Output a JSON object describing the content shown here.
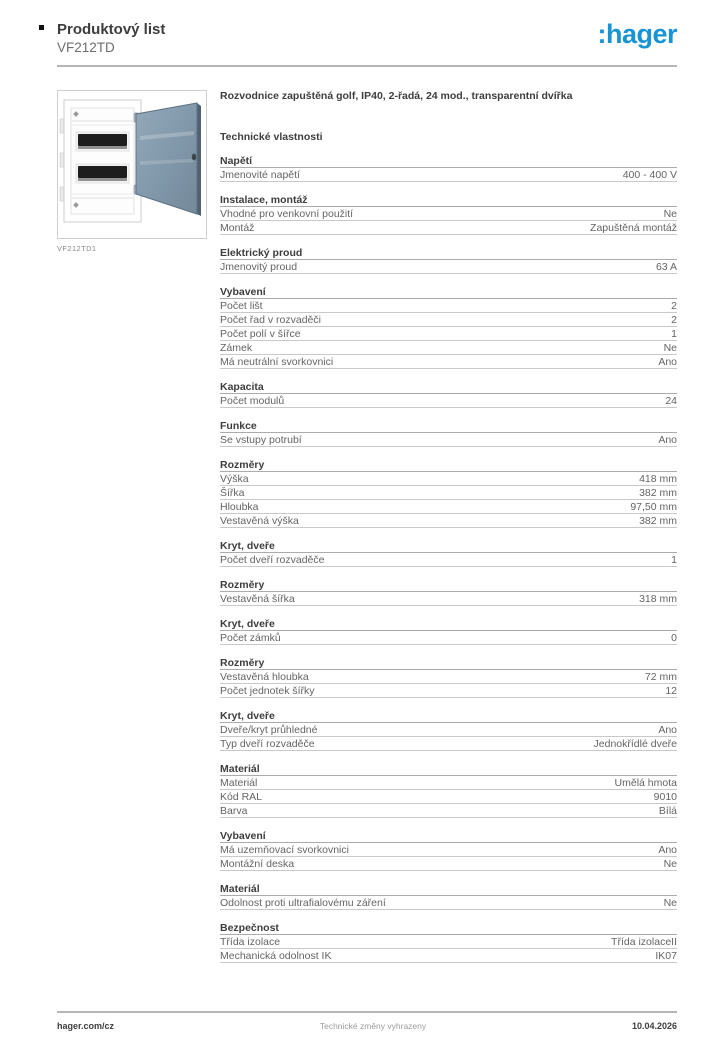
{
  "header": {
    "doc_type": "Produktový list",
    "product_code": "VF212TD",
    "brand_logo": ":hager",
    "brand_color": "#1794d1"
  },
  "figure": {
    "caption": "VF212TD1",
    "image_name": "flush-mounted-distribution-board-with-transparent-door",
    "door_color": "#8499ab",
    "enclosure_color": "#ffffff"
  },
  "description": "Rozvodnice zapuštěná golf, IP40, 2-řadá, 24 mod., transparentní dvířka",
  "tech_heading": "Technické vlastnosti",
  "sections": [
    {
      "title": "Napětí",
      "rows": [
        {
          "label": "Jmenovité napětí",
          "value": "400 - 400 V"
        }
      ]
    },
    {
      "title": "Instalace, montáž",
      "rows": [
        {
          "label": "Vhodné pro venkovní použití",
          "value": "Ne"
        },
        {
          "label": "Montáž",
          "value": "Zapuštěná montáž"
        }
      ]
    },
    {
      "title": "Elektrický proud",
      "rows": [
        {
          "label": "Jmenovitý proud",
          "value": "63 A"
        }
      ]
    },
    {
      "title": "Vybavení",
      "rows": [
        {
          "label": "Počet lišt",
          "value": "2"
        },
        {
          "label": "Počet řad v rozvaděči",
          "value": "2"
        },
        {
          "label": "Počet polí v šířce",
          "value": "1"
        },
        {
          "label": "Zámek",
          "value": "Ne"
        },
        {
          "label": "Má neutrální svorkovnici",
          "value": "Ano"
        }
      ]
    },
    {
      "title": "Kapacita",
      "rows": [
        {
          "label": "Počet modulů",
          "value": "24"
        }
      ]
    },
    {
      "title": "Funkce",
      "rows": [
        {
          "label": "Se vstupy potrubí",
          "value": "Ano"
        }
      ]
    },
    {
      "title": "Rozměry",
      "rows": [
        {
          "label": "Výška",
          "value": "418 mm"
        },
        {
          "label": "Šířka",
          "value": "382 mm"
        },
        {
          "label": "Hloubka",
          "value": "97,50 mm"
        },
        {
          "label": "Vestavěná výška",
          "value": "382 mm"
        }
      ]
    },
    {
      "title": "Kryt, dveře",
      "rows": [
        {
          "label": "Počet dveří rozvaděče",
          "value": "1"
        }
      ]
    },
    {
      "title": "Rozměry",
      "rows": [
        {
          "label": "Vestavěná šířka",
          "value": "318 mm"
        }
      ]
    },
    {
      "title": "Kryt, dveře",
      "rows": [
        {
          "label": "Počet zámků",
          "value": "0"
        }
      ]
    },
    {
      "title": "Rozměry",
      "rows": [
        {
          "label": "Vestavěná hloubka",
          "value": "72 mm"
        },
        {
          "label": "Počet jednotek šířky",
          "value": "12"
        }
      ]
    },
    {
      "title": "Kryt, dveře",
      "rows": [
        {
          "label": "Dveře/kryt průhledné",
          "value": "Ano"
        },
        {
          "label": "Typ dveří rozvaděče",
          "value": "Jednokřídlé dveře"
        }
      ]
    },
    {
      "title": "Materiál",
      "rows": [
        {
          "label": "Materiál",
          "value": "Umělá hmota"
        },
        {
          "label": "Kód RAL",
          "value": "9010"
        },
        {
          "label": "Barva",
          "value": "Bílá"
        }
      ]
    },
    {
      "title": "Vybavení",
      "rows": [
        {
          "label": "Má uzemňovací svorkovnici",
          "value": "Ano"
        },
        {
          "label": "Montážní deska",
          "value": "Ne"
        }
      ]
    },
    {
      "title": "Materiál",
      "rows": [
        {
          "label": "Odolnost proti ultrafialovému záření",
          "value": "Ne"
        }
      ]
    },
    {
      "title": "Bezpečnost",
      "rows": [
        {
          "label": "Třída izolace",
          "value": "Třída izolaceII"
        },
        {
          "label": "Mechanická odolnost IK",
          "value": "IK07"
        }
      ]
    }
  ],
  "footer": {
    "website": "hager.com/cz",
    "disclaimer": "Technické změny vyhrazeny",
    "date": "10.04.2026"
  }
}
